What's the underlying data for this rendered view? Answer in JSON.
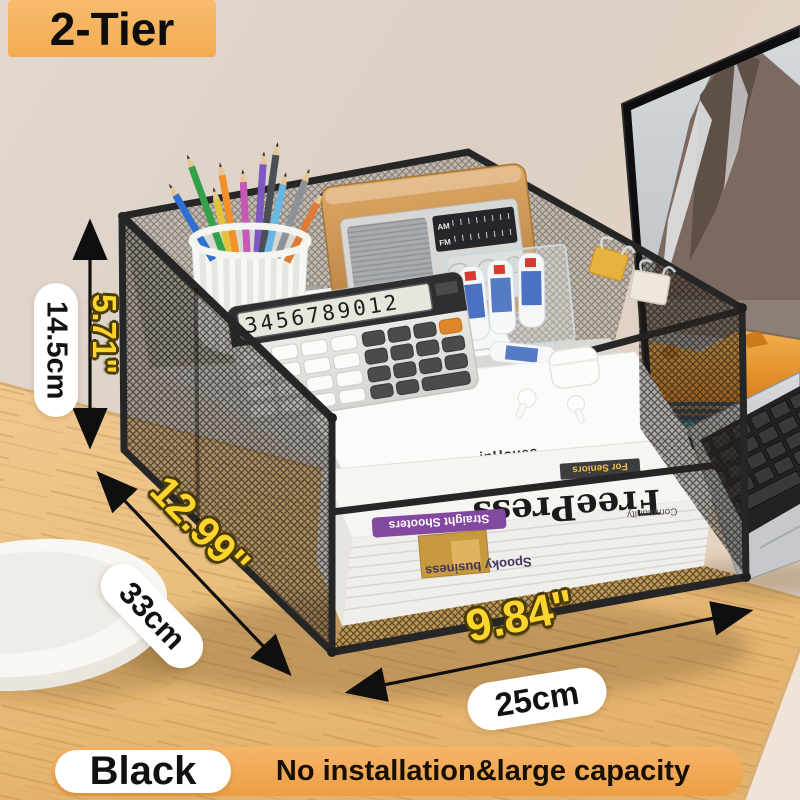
{
  "badge": {
    "label": "2-Tier"
  },
  "dimensions": {
    "height": {
      "metric": "14.5cm",
      "imperial": "5.71\""
    },
    "depth": {
      "metric": "33cm",
      "imperial": "12.99\""
    },
    "width": {
      "metric": "25cm",
      "imperial": "9.84\""
    }
  },
  "footer": {
    "color_label": "Black",
    "tagline": "No installation&large capacity"
  },
  "product": {
    "calculator_display": "3456789012",
    "notebook_brand": "inHoues",
    "radio": {
      "band1": "AM",
      "band2": "FM"
    },
    "magazine": {
      "line1": "RM",
      "line2": "HA"
    },
    "newspaper": {
      "masthead": "FreePress",
      "tag": "Community",
      "headline1": "Straight Shooters",
      "headline2": "Spooky business",
      "corner": "For Seniors"
    }
  },
  "colors": {
    "badge_orange": "#f5b05c",
    "footer_orange": "#f0a64e",
    "dimension_yellow": "#ffd42d",
    "pill_white": "#ffffff",
    "frame_black": "#262626",
    "desk_wood": "#ecc286",
    "wall_beige": "#ddd2c8"
  }
}
